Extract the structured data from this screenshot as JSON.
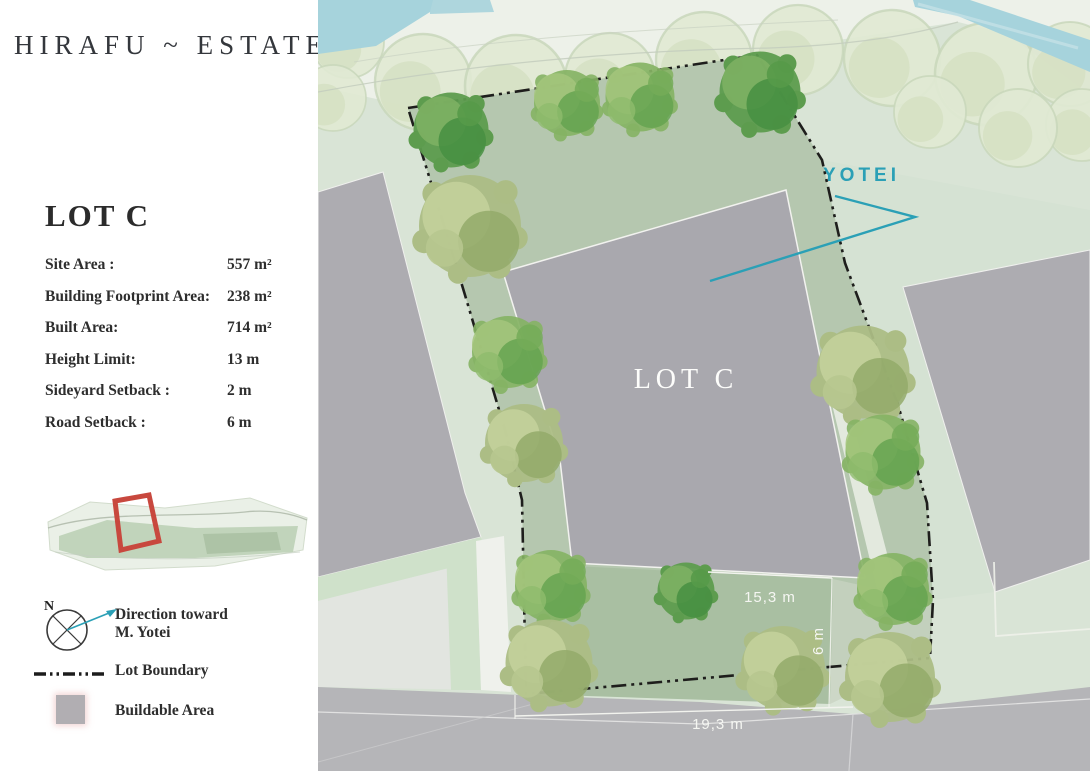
{
  "brand": {
    "title": "HIRAFU ~ ESTATE"
  },
  "lot": {
    "heading": "LOT C",
    "specs": [
      {
        "label": "Site Area :",
        "value": "557 m²"
      },
      {
        "label": "Building Footprint Area:",
        "value": "238 m²"
      },
      {
        "label": "Built Area:",
        "value": "714 m²"
      },
      {
        "label": "Height Limit:",
        "value": "13 m"
      },
      {
        "label": "Sideyard Setback :",
        "value": "2 m"
      },
      {
        "label": "Road Setback :",
        "value": "6 m"
      }
    ]
  },
  "legend": {
    "compass_label": "N",
    "direction_line1": "Direction toward",
    "direction_line2": "M. Yotei",
    "lot_boundary_label": "Lot Boundary",
    "buildable_area_label": "Buildable Area"
  },
  "map": {
    "lot_label": "LOT C",
    "yotei_label": "YOTEI",
    "dimensions": [
      "15,3 m",
      "6 m",
      "19,3 m"
    ]
  },
  "colors": {
    "accent_teal": "#2BA0B6",
    "boundary_black": "#1E1E1C",
    "buildable_gray": "#A9A8AE",
    "lot_green": "#B5C7AF",
    "locator_red": "#C8483E"
  }
}
